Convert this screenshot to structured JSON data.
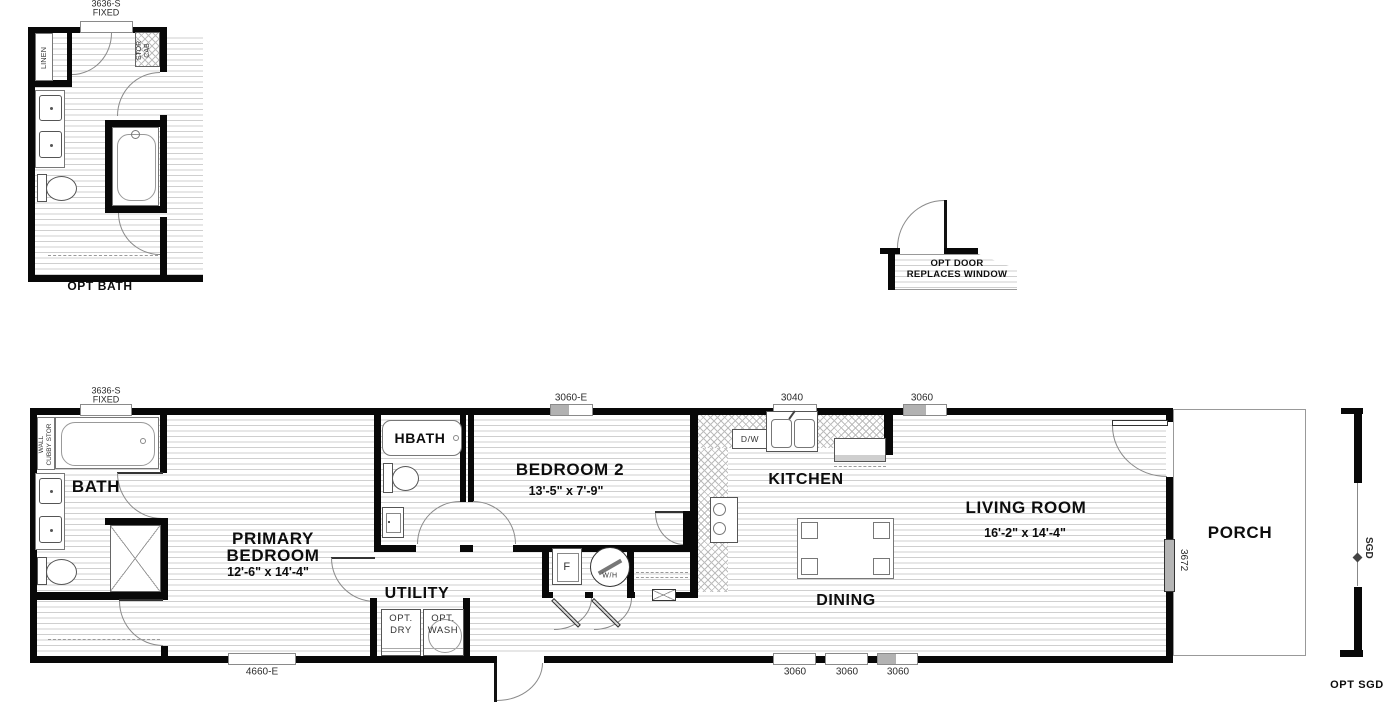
{
  "opt_bath_detail": {
    "window_label": [
      "3636-S",
      "FIXED"
    ],
    "linen_label": "LINEN",
    "stor_cab_label": [
      "STOR",
      "CAB"
    ],
    "caption": "OPT BATH"
  },
  "opt_door_detail": {
    "line1": "OPT DOOR",
    "line2": "REPLACES WINDOW"
  },
  "main_plan": {
    "top_windows": {
      "w1": [
        "3636-S",
        "FIXED"
      ],
      "w2": "3060-E",
      "w3": "3040",
      "w4": "3060"
    },
    "bottom_windows": {
      "w1": "4660-E",
      "w2": "3060",
      "w3": "3060",
      "w4": "3060"
    },
    "right_wall": {
      "sliding_door_label": "3672"
    },
    "rooms": {
      "bath": {
        "name": "BATH",
        "wall_cubby": [
          "WALL",
          "CUBBY STOR"
        ]
      },
      "primary_bedroom": {
        "name1": "PRIMARY",
        "name2": "BEDROOM",
        "dims": "12'-6\" x  14'-4\""
      },
      "hbath": {
        "name": "HBATH"
      },
      "bedroom2": {
        "name": "BEDROOM 2",
        "dims": "13'-5\" x  7'-9\""
      },
      "utility": {
        "name": "UTILITY",
        "opt_dry": [
          "OPT.",
          "DRY"
        ],
        "opt_wash": [
          "OPT.",
          "WASH"
        ],
        "furnace": "F",
        "water_heater": "W/H"
      },
      "kitchen": {
        "name": "KITCHEN",
        "dishwasher": "D/W"
      },
      "dining": {
        "name": "DINING"
      },
      "living_room": {
        "name": "LIVING ROOM",
        "dims": "16'-2\" x  14'-4\""
      },
      "porch": {
        "name": "PORCH"
      }
    }
  },
  "sgd_detail": {
    "door_label": "SGD",
    "caption": "OPT SGD"
  },
  "colors": {
    "wall": "#080808",
    "floor_line": "#cfcfcf",
    "egress_fill": "#b2b2b2",
    "slider_fill": "#b5b5b5"
  }
}
